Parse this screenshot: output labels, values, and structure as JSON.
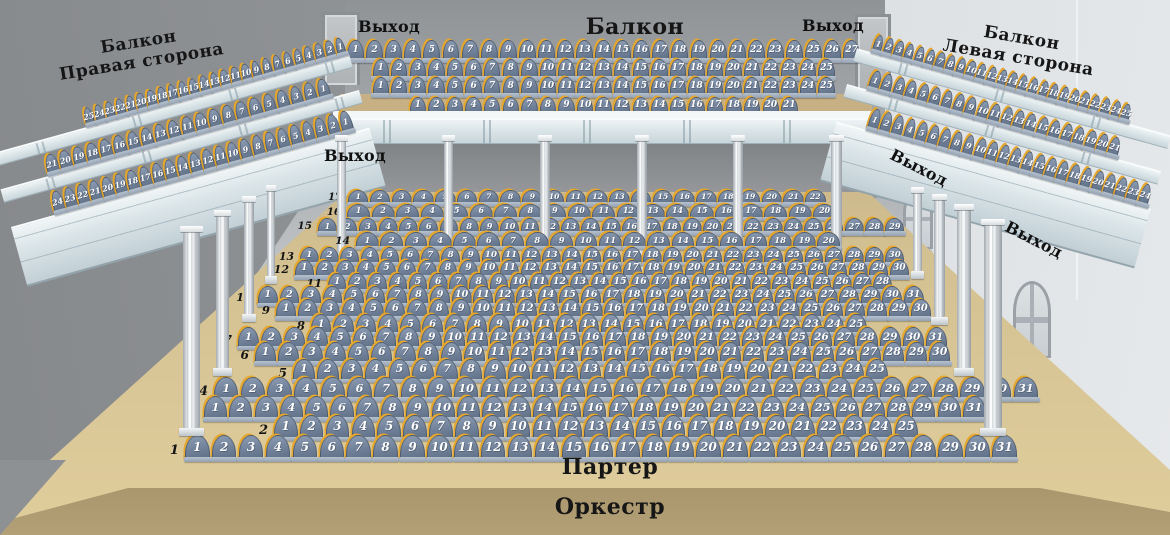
{
  "sections": {
    "balcony_center": {
      "label": "Балкон",
      "rows": [
        {
          "seats": 27
        },
        {
          "seats": 25
        },
        {
          "seats": 25
        },
        {
          "seats": 21
        }
      ]
    },
    "balcony_right_side": {
      "label_line1": "Балкон",
      "label_line2": "Правая сторона",
      "number_direction": "descending",
      "rows": [
        {
          "seats": 25
        },
        {
          "seats": 21
        },
        {
          "seats": 24
        }
      ]
    },
    "balcony_left_side": {
      "label_line1": "Балкон",
      "label_line2": "Левая сторона",
      "number_direction": "ascending",
      "rows": [
        {
          "seats": 25
        },
        {
          "seats": 21
        },
        {
          "seats": 24
        }
      ]
    },
    "parterre": {
      "label": "Партер",
      "rows": [
        {
          "row": 17,
          "seats": 22
        },
        {
          "row": 16,
          "seats": 20
        },
        {
          "row": 15,
          "seats": 29
        },
        {
          "row": 14,
          "seats": 20
        },
        {
          "row": 13,
          "seats": 30
        },
        {
          "row": 12,
          "seats": 30
        },
        {
          "row": 11,
          "seats": 28
        },
        {
          "row": 10,
          "seats": 31
        },
        {
          "row": 9,
          "seats": 30
        },
        {
          "row": 8,
          "seats": 25
        },
        {
          "row": 7,
          "seats": 31
        },
        {
          "row": 6,
          "seats": 30
        },
        {
          "row": 5,
          "seats": 25
        },
        {
          "row": 4,
          "seats": 31
        },
        {
          "row": 3,
          "seats": 31
        },
        {
          "row": 2,
          "seats": 25
        },
        {
          "row": 1,
          "seats": 31
        }
      ]
    },
    "orchestra": {
      "label": "Оркестр"
    }
  },
  "exit_labels": [
    {
      "position": "top-left",
      "label": "Выход"
    },
    {
      "position": "top-right",
      "label": "Выход"
    },
    {
      "position": "middle-left",
      "label": "Выход"
    },
    {
      "position": "right-upper",
      "label": "Выход"
    },
    {
      "position": "right-lower",
      "label": "Выход"
    }
  ],
  "colors": {
    "seat_fill": "#6f8098",
    "seat_highlight": "#8899b0",
    "seat_shadow": "#5f7086",
    "seat_trim": "#e5a62c",
    "seat_trim_dark": "#c8912a",
    "seat_base": "#b6c1ce",
    "seat_number": "#ffffff",
    "floor": "#d4c192",
    "wall": "#9b9ea1",
    "railing": "#e8eef0",
    "orchestra_dark": "#4e4129"
  }
}
